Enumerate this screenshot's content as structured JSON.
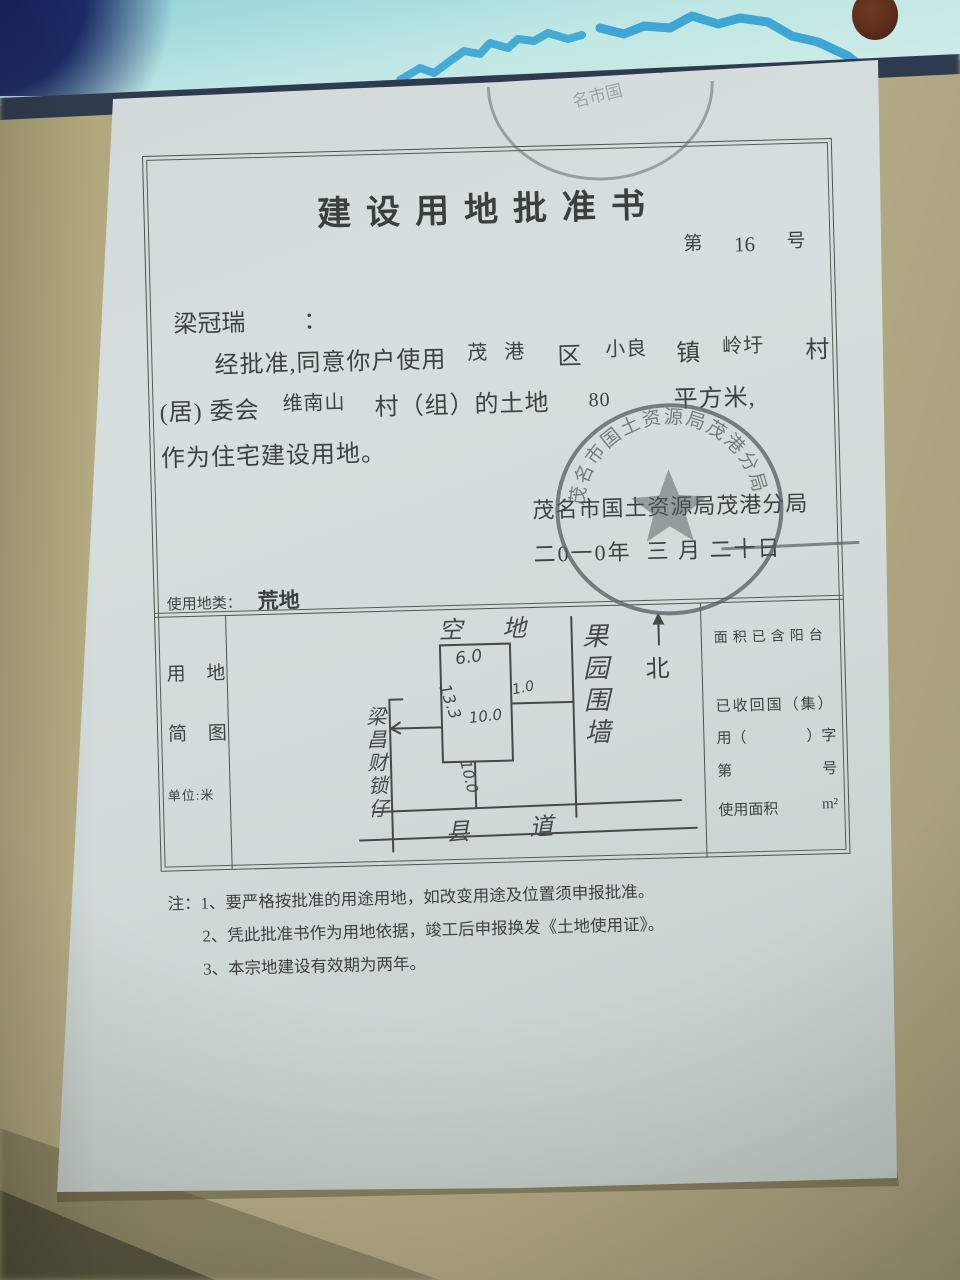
{
  "doc": {
    "title": "建设用地批准书",
    "number_prefix": "第",
    "number": "16",
    "number_suffix": "号",
    "addressee": "梁冠瑞",
    "colon": "：",
    "line1": {
      "printed": "经批准,同意你户使用",
      "district": "茂 港",
      "district_suffix": "区",
      "town": "小良",
      "town_suffix": "镇",
      "village": "岭圩",
      "village_suffix": "村"
    },
    "line2": {
      "prefix": "(居) 委会",
      "hamlet": "维南山",
      "mid": "村（组）的土地",
      "area": "80",
      "suffix": "平方米,"
    },
    "line3": "作为住宅建设用地。",
    "issuer": "茂名市国土资源局茂港分局",
    "date": "二0一0年  三 月 二十日",
    "land_class_label": "使用地类：",
    "land_class_value": "荒地"
  },
  "diagram": {
    "col_left": {
      "l1": "用 地",
      "l2": "简 图",
      "unit": "单位:米"
    },
    "north": "北",
    "labels": {
      "open_space": "空  地",
      "orchard_wall": "果园围墙",
      "road": "县  道",
      "neighbor": "梁昌财锁仔"
    },
    "dims": {
      "top": "6.0",
      "side": "13.3",
      "right": "1.0",
      "left": "10.0",
      "bottom": "10.0"
    },
    "right_col": {
      "r1": "面积已含阳台",
      "r2": "已收回国（集）",
      "r3a": "用（",
      "r3b": "）字",
      "r4a": "第",
      "r4b": "号",
      "r5a": "使用面积",
      "r5b": "m²"
    }
  },
  "notes": {
    "label": "注：",
    "n1": "1、要严格按批准的用途用地，如改变用途及位置须申报批准。",
    "n2": "2、凭此批准书作为用地依据，竣工后申报换发《土地使用证》。",
    "n3": "3、本宗地建设有效期为两年。"
  },
  "seal": {
    "ring_text": "茂名市国土资源局茂港分局",
    "star": "★"
  },
  "partial_stamp": {
    "c1": "名市国",
    "c2": "分",
    "c3": "局"
  },
  "colors": {
    "paper": "#d3dcda",
    "printed_ink": "#3d4341",
    "hand_ink": "#45494c",
    "frame_line": "#4e544e",
    "seal_ink": "#5a6065",
    "table": "#b3aa85",
    "map_cyan": "#9fd8de",
    "map_coast": "#2f9fd2",
    "map_navy": "#1b2b66",
    "map_edge": "#2e3b4f",
    "knob_brown": "#5c2d1b"
  }
}
